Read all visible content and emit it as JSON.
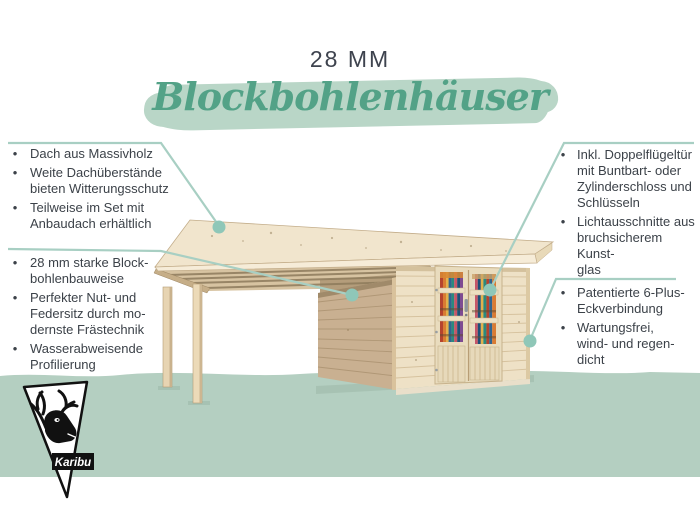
{
  "header": {
    "size_label": "28 MM",
    "title": "Blockbohlenhäuser"
  },
  "features": {
    "left_top": {
      "items": [
        {
          "text": "Dach aus Massivholz"
        },
        {
          "text": "Weite Dachüberstände\nbieten Witterungsschutz"
        },
        {
          "text": "Teilweise im Set mit\nAnbaudach erhältlich"
        }
      ]
    },
    "left_bottom": {
      "items": [
        {
          "text": "28 mm starke Block-\nbohlenbauweise"
        },
        {
          "text": "Perfekter Nut- und\nFedersitz durch mo-\ndernste Frästechnik"
        },
        {
          "text": "Wasserabweisende\nProfilierung"
        }
      ]
    },
    "right_top": {
      "items": [
        {
          "text": "Inkl. Doppelflügeltür\nmit Buntbart- oder\nZylinderschloss und\nSchlüsseln"
        },
        {
          "text": "Lichtausschnitte aus\nbruchsicherem Kunst-\nglas"
        }
      ]
    },
    "right_bottom": {
      "items": [
        {
          "text": "Patentierte 6-Plus-\nEckverbindung"
        },
        {
          "text": "Wartungsfrei,\nwind- und regen-\ndicht"
        }
      ]
    }
  },
  "logo": {
    "brand": "Karibu"
  },
  "ui": {
    "bullet": "•"
  },
  "illustration": {
    "subject_icon": "flat-roof-log-cabin-with-side-canopy-icon"
  },
  "colors": {
    "callout_line": "#a8cfc3",
    "callout_dot": "#8fc7b8",
    "band": "#b4cfc1",
    "brush": "#b9d6c7",
    "script_title": "#53a287",
    "body_text": "#3c4249",
    "wood_light": "#eee1c6",
    "wood_dark": "#c9b091",
    "roof": "#f1e5cd"
  }
}
